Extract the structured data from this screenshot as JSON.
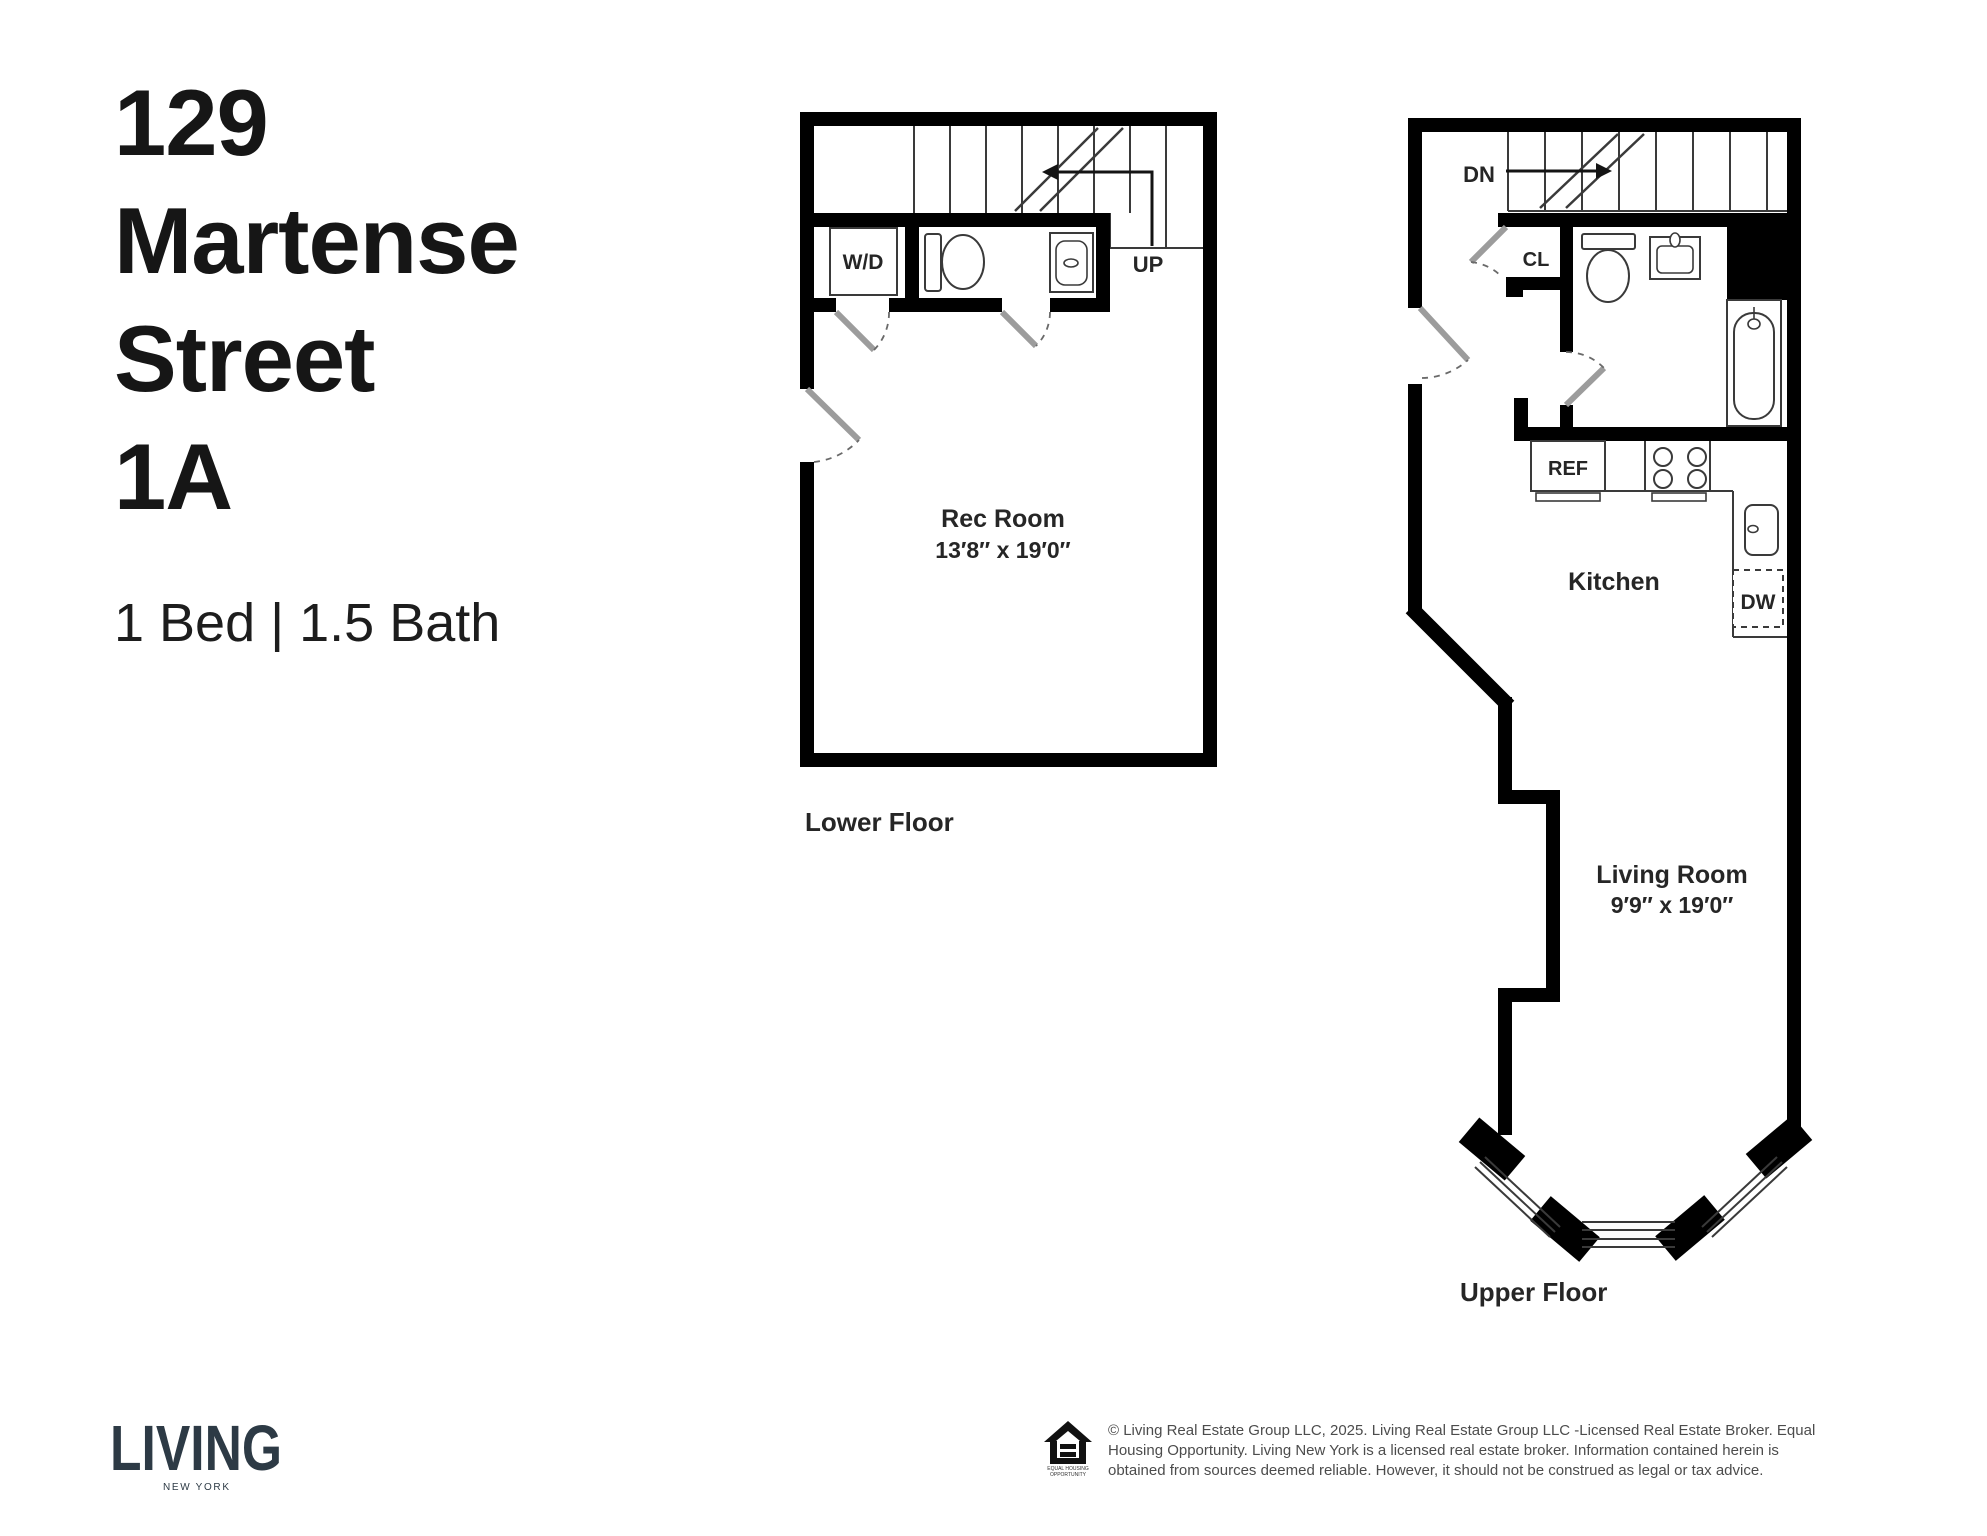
{
  "header": {
    "address_lines": [
      "129",
      "Martense",
      "Street",
      "1A"
    ],
    "specs": "1 Bed | 1.5 Bath"
  },
  "lower_plan": {
    "caption": "Lower Floor",
    "labels": {
      "wd": "W/D",
      "up": "UP",
      "room_name": "Rec Room",
      "room_dims": "13′8″ x 19′0″"
    }
  },
  "upper_plan": {
    "caption": "Upper Floor",
    "labels": {
      "dn": "DN",
      "cl": "CL",
      "ref": "REF",
      "dw": "DW",
      "kitchen": "Kitchen",
      "living_name": "Living Room",
      "living_dims": "9′9″ x 19′0″"
    }
  },
  "footer": {
    "brand": "LIVING",
    "brand_subtitle": "NEW YORK",
    "eho": {
      "line1": "EQUAL HOUSING",
      "line2": "OPPORTUNITY"
    },
    "legal_lines": [
      "© Living Real Estate Group LLC, 2025. Living Real Estate Group LLC -Licensed Real Estate Broker. Equal",
      "Housing Opportunity. Living New York is a licensed real estate broker. Information contained herein is",
      "obtained from sources deemed reliable. However, it should not be construed as legal or tax advice."
    ]
  },
  "colors": {
    "wall": "#000000",
    "thin_line": "#3a3a3a",
    "door": "#9c9c9c",
    "brand": "#2d3a45",
    "title_text": "#161616",
    "legal_text": "#4c4c4c"
  }
}
